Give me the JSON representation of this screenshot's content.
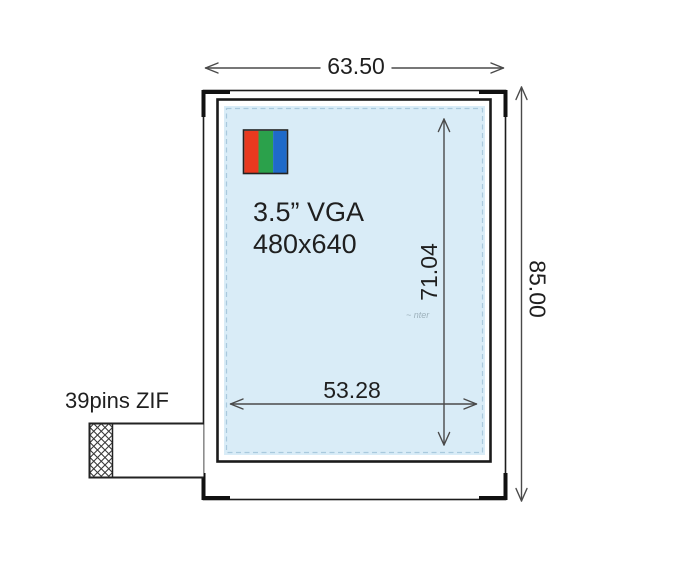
{
  "diagram": {
    "title": "LCD module outline drawing",
    "screen": {
      "size_label": "3.5” VGA",
      "resolution_label": "480x640"
    },
    "connector": {
      "label": "39pins ZIF"
    },
    "dimensions": {
      "module_width_mm": "63.50",
      "module_height_mm": "85.00",
      "active_width_mm": "53.28",
      "active_height_mm": "71.04"
    },
    "watermark": "~ nter",
    "colors": {
      "active_area_fill": "#d9ecf7",
      "active_area_dash": "#a9c9dd",
      "swatch_red": "#e8391f",
      "swatch_green": "#2ba14b",
      "swatch_blue": "#1f6ac9",
      "outline": "#1c1c1c",
      "dimension_line": "#4a4a4a",
      "text": "#1f1f1f"
    }
  }
}
